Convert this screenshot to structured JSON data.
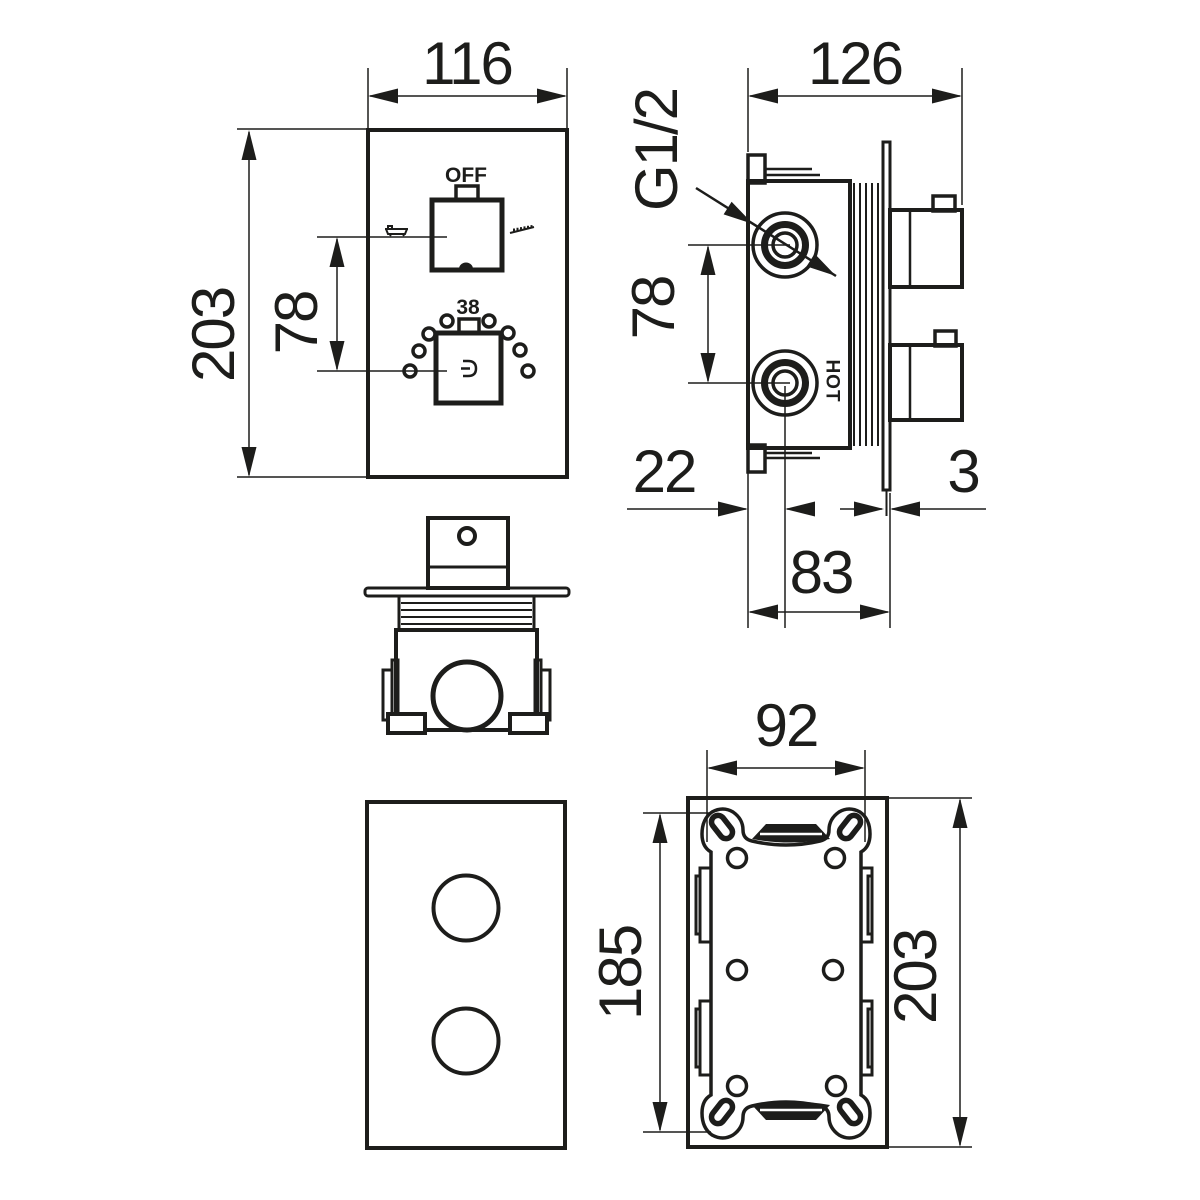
{
  "drawing": {
    "type": "technical-dimension-drawing",
    "subject": "concealed thermostatic shower mixer valve",
    "colors": {
      "ink": "#1d1d1b",
      "background": "#ffffff"
    },
    "front": {
      "width": "116",
      "height": "203",
      "spacing": "78",
      "off": "OFF",
      "temp": "38"
    },
    "side": {
      "width": "126",
      "thread": "G1/2",
      "spacing": "78",
      "offset": "22",
      "plate": "3",
      "depth": "83",
      "hot": "HOT"
    },
    "box": {
      "width": "92",
      "plate_height": "185",
      "height": "203"
    },
    "icons": {
      "left_mode": "bath-icon",
      "right_mode": "shower-spray-icon",
      "knob_center": "brand-logo-icon"
    }
  }
}
